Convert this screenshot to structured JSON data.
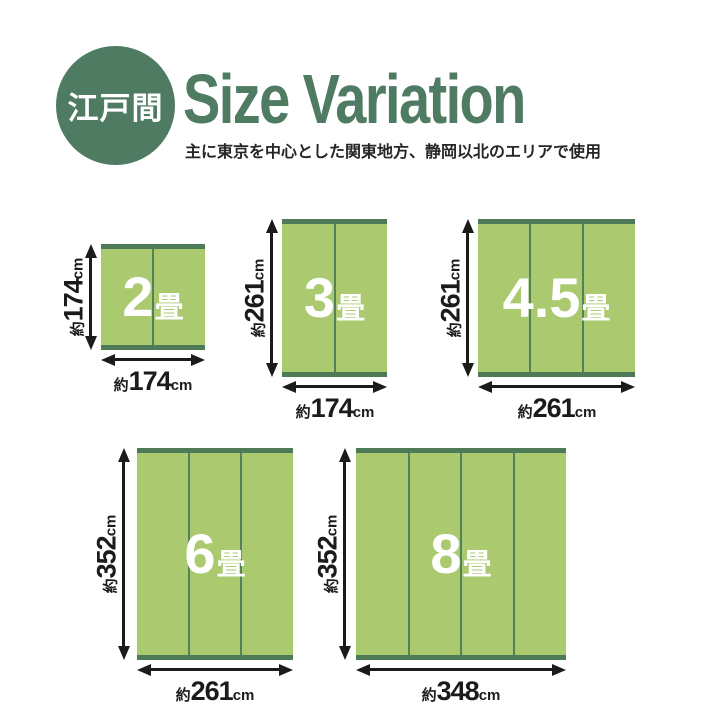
{
  "header": {
    "badge": "江戸間",
    "title": "Size Variation",
    "subtitle": "主に東京を中心とした関東地方、静岡以北のエリアで使用"
  },
  "colors": {
    "brand_green": "#4e7b61",
    "mat_body": "#abc96f",
    "mat_edge": "#4e7a57",
    "mat_divider": "#55815a",
    "ink": "#1b1b1b",
    "mat_text": "#ffffff"
  },
  "mats": [
    {
      "size_label": "2畳",
      "num": "2",
      "tatami": "畳",
      "panels": 2,
      "width": {
        "approx": "約",
        "value": "174",
        "unit": "cm"
      },
      "height": {
        "approx": "約",
        "value": "174",
        "unit": "cm"
      }
    },
    {
      "size_label": "3畳",
      "num": "3",
      "tatami": "畳",
      "panels": 2,
      "width": {
        "approx": "約",
        "value": "174",
        "unit": "cm"
      },
      "height": {
        "approx": "約",
        "value": "261",
        "unit": "cm"
      }
    },
    {
      "size_label": "4.5畳",
      "num": "4.5",
      "tatami": "畳",
      "panels": 3,
      "width": {
        "approx": "約",
        "value": "261",
        "unit": "cm"
      },
      "height": {
        "approx": "約",
        "value": "261",
        "unit": "cm"
      }
    },
    {
      "size_label": "6畳",
      "num": "6",
      "tatami": "畳",
      "panels": 3,
      "width": {
        "approx": "約",
        "value": "261",
        "unit": "cm"
      },
      "height": {
        "approx": "約",
        "value": "352",
        "unit": "cm"
      }
    },
    {
      "size_label": "8畳",
      "num": "8",
      "tatami": "畳",
      "panels": 4,
      "width": {
        "approx": "約",
        "value": "348",
        "unit": "cm"
      },
      "height": {
        "approx": "約",
        "value": "352",
        "unit": "cm"
      }
    }
  ]
}
